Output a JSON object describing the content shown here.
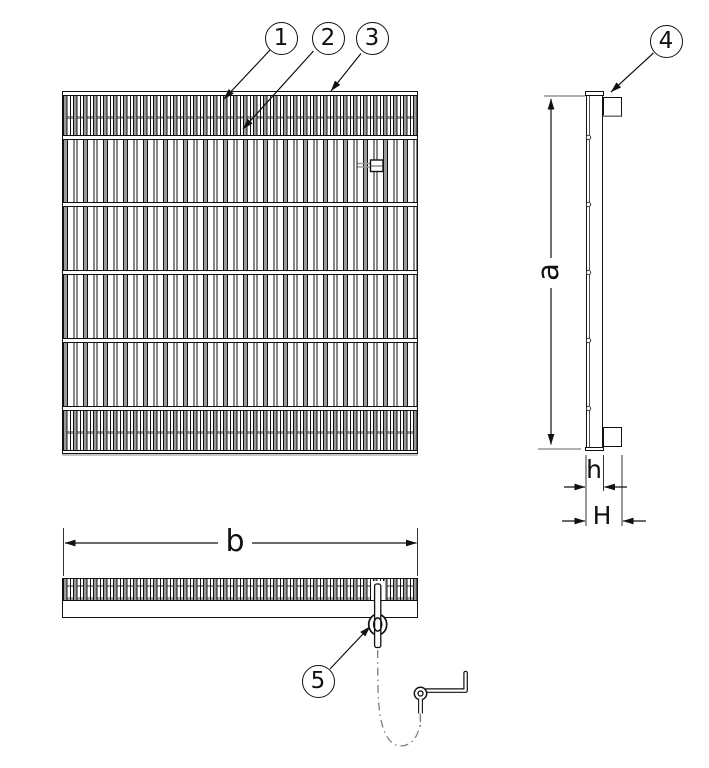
{
  "callouts": {
    "c1": "1",
    "c2": "2",
    "c3": "3",
    "c4": "4",
    "c5": "5"
  },
  "dims": {
    "a": "a",
    "b": "b",
    "h": "h",
    "H": "H"
  },
  "colors": {
    "line": "#1a1a1a",
    "bar_gray": "#9a9a9a",
    "phantom_gray": "#808080",
    "background": "#ffffff"
  }
}
